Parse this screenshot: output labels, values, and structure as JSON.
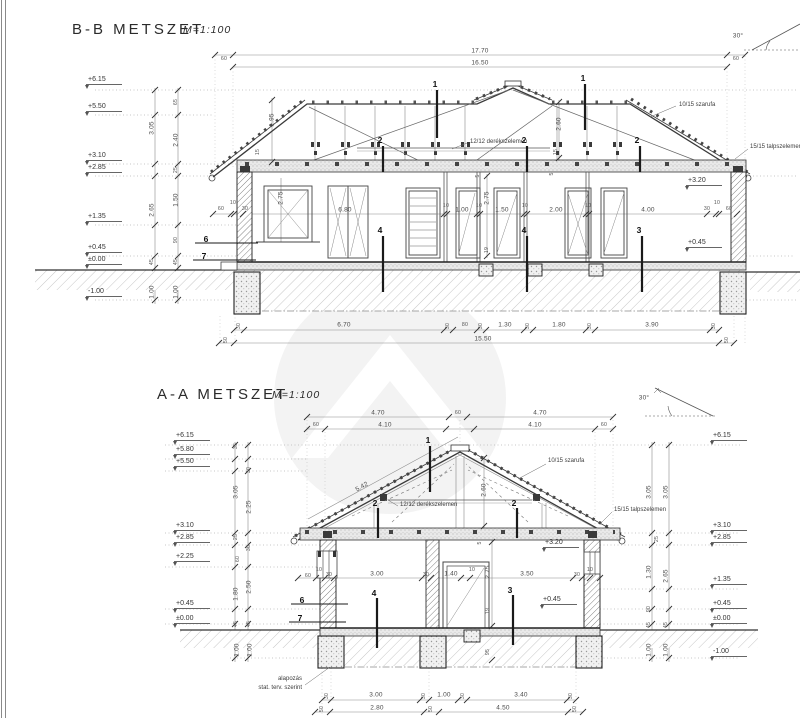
{
  "page": {
    "title_bb": "B-B METSZET",
    "scale_bb": "M=1:100",
    "title_aa": "A-A METSZET",
    "scale_aa": "M=1:100"
  },
  "bb": {
    "dims": [
      {
        "t": "17.70",
        "x": 480,
        "y": 51
      },
      {
        "t": "16.50",
        "x": 480,
        "y": 63
      },
      {
        "t": "60",
        "x": 224,
        "y": 59,
        "s": 1
      },
      {
        "t": "60",
        "x": 736,
        "y": 59,
        "s": 1
      },
      {
        "t": "30°",
        "x": 738,
        "y": 36
      },
      {
        "t": "3.05",
        "x": 152,
        "y": 128,
        "r": 1
      },
      {
        "t": "65",
        "x": 176,
        "y": 102,
        "r": 1,
        "s": 1
      },
      {
        "t": "2.40",
        "x": 176,
        "y": 140,
        "r": 1
      },
      {
        "t": "25",
        "x": 176,
        "y": 170,
        "r": 1,
        "s": 1
      },
      {
        "t": "2.65",
        "x": 152,
        "y": 210,
        "r": 1
      },
      {
        "t": "1.50",
        "x": 176,
        "y": 200,
        "r": 1
      },
      {
        "t": "90",
        "x": 176,
        "y": 240,
        "r": 1,
        "s": 1
      },
      {
        "t": "45",
        "x": 152,
        "y": 262,
        "r": 1,
        "s": 1
      },
      {
        "t": "45",
        "x": 176,
        "y": 262,
        "r": 1,
        "s": 1
      },
      {
        "t": "1.00",
        "x": 152,
        "y": 292,
        "r": 1
      },
      {
        "t": "1.00",
        "x": 176,
        "y": 292,
        "r": 1
      },
      {
        "t": "1.95",
        "x": 272,
        "y": 120,
        "r": 1
      },
      {
        "t": "15",
        "x": 258,
        "y": 152,
        "r": 1,
        "s": 1
      },
      {
        "t": "60",
        "x": 221,
        "y": 209,
        "s": 1
      },
      {
        "t": "10",
        "x": 233,
        "y": 203,
        "s": 1
      },
      {
        "t": "30",
        "x": 245,
        "y": 209,
        "s": 1
      },
      {
        "t": "6.80",
        "x": 345,
        "y": 210
      },
      {
        "t": "10",
        "x": 446,
        "y": 206,
        "s": 1
      },
      {
        "t": "1.00",
        "x": 462,
        "y": 210
      },
      {
        "t": "10",
        "x": 479,
        "y": 206,
        "s": 1
      },
      {
        "t": "1.50",
        "x": 502,
        "y": 210
      },
      {
        "t": "10",
        "x": 525,
        "y": 206,
        "s": 1
      },
      {
        "t": "2.00",
        "x": 556,
        "y": 210
      },
      {
        "t": "10",
        "x": 588,
        "y": 206,
        "s": 1
      },
      {
        "t": "4.00",
        "x": 648,
        "y": 210
      },
      {
        "t": "30",
        "x": 707,
        "y": 209,
        "s": 1
      },
      {
        "t": "10",
        "x": 717,
        "y": 203,
        "s": 1
      },
      {
        "t": "60",
        "x": 729,
        "y": 209,
        "s": 1
      },
      {
        "t": "5",
        "x": 478,
        "y": 176,
        "r": 1,
        "s": 1
      },
      {
        "t": "2.75",
        "x": 487,
        "y": 198,
        "r": 1
      },
      {
        "t": "19",
        "x": 487,
        "y": 250,
        "r": 1,
        "s": 1
      },
      {
        "t": "2.75",
        "x": 281,
        "y": 198,
        "r": 1
      },
      {
        "t": "2.60",
        "x": 559,
        "y": 124,
        "r": 1
      },
      {
        "t": "15",
        "x": 556,
        "y": 152,
        "r": 1,
        "s": 1
      },
      {
        "t": "5",
        "x": 552,
        "y": 174,
        "r": 1,
        "s": 1
      },
      {
        "t": "30",
        "x": 239,
        "y": 326,
        "r": 1,
        "s": 1
      },
      {
        "t": "6.70",
        "x": 344,
        "y": 325
      },
      {
        "t": "30",
        "x": 448,
        "y": 326,
        "r": 1,
        "s": 1
      },
      {
        "t": "80",
        "x": 465,
        "y": 325,
        "s": 1
      },
      {
        "t": "30",
        "x": 481,
        "y": 326,
        "r": 1,
        "s": 1
      },
      {
        "t": "1.30",
        "x": 505,
        "y": 325
      },
      {
        "t": "30",
        "x": 528,
        "y": 326,
        "r": 1,
        "s": 1
      },
      {
        "t": "1.80",
        "x": 559,
        "y": 325
      },
      {
        "t": "30",
        "x": 590,
        "y": 326,
        "r": 1,
        "s": 1
      },
      {
        "t": "3.90",
        "x": 652,
        "y": 325
      },
      {
        "t": "30",
        "x": 714,
        "y": 326,
        "r": 1,
        "s": 1
      },
      {
        "t": "50",
        "x": 226,
        "y": 340,
        "r": 1,
        "s": 1
      },
      {
        "t": "15.50",
        "x": 483,
        "y": 339
      },
      {
        "t": "50",
        "x": 727,
        "y": 340,
        "r": 1,
        "s": 1
      }
    ],
    "elevs": [
      {
        "t": "+6.15",
        "x": 86,
        "y": 76
      },
      {
        "t": "+5.50",
        "x": 86,
        "y": 103
      },
      {
        "t": "+3.10",
        "x": 86,
        "y": 152
      },
      {
        "t": "+2.85",
        "x": 86,
        "y": 164
      },
      {
        "t": "+1.35",
        "x": 86,
        "y": 213
      },
      {
        "t": "+0.45",
        "x": 86,
        "y": 244
      },
      {
        "t": "±0.00",
        "x": 86,
        "y": 256
      },
      {
        "t": "-1.00",
        "x": 86,
        "y": 288
      },
      {
        "t": "+3.20",
        "x": 686,
        "y": 177
      },
      {
        "t": "+0.45",
        "x": 686,
        "y": 239
      }
    ],
    "labels": [
      {
        "t": "1",
        "x": 435,
        "y": 84
      },
      {
        "t": "1",
        "x": 583,
        "y": 78
      },
      {
        "t": "2",
        "x": 380,
        "y": 140
      },
      {
        "t": "2",
        "x": 524,
        "y": 140
      },
      {
        "t": "2",
        "x": 637,
        "y": 140
      },
      {
        "t": "4",
        "x": 380,
        "y": 230
      },
      {
        "t": "4",
        "x": 524,
        "y": 230
      },
      {
        "t": "3",
        "x": 639,
        "y": 230
      },
      {
        "t": "6",
        "x": 206,
        "y": 239
      },
      {
        "t": "7",
        "x": 204,
        "y": 256
      }
    ],
    "notes": [
      {
        "t": "10/15 szarufa",
        "x": 679,
        "y": 105
      },
      {
        "t": "12/12 derékszelemen",
        "x": 470,
        "y": 142
      },
      {
        "t": "15/15 talpszelemen",
        "x": 750,
        "y": 147
      }
    ]
  },
  "aa": {
    "dims": [
      {
        "t": "4.70",
        "x": 378,
        "y": 413
      },
      {
        "t": "60",
        "x": 458,
        "y": 413,
        "s": 1
      },
      {
        "t": "4.70",
        "x": 540,
        "y": 413
      },
      {
        "t": "60",
        "x": 316,
        "y": 425,
        "s": 1
      },
      {
        "t": "4.10",
        "x": 385,
        "y": 425
      },
      {
        "t": "4.10",
        "x": 535,
        "y": 425
      },
      {
        "t": "60",
        "x": 604,
        "y": 425,
        "s": 1
      },
      {
        "t": "30°",
        "x": 644,
        "y": 398
      },
      {
        "t": "35",
        "x": 236,
        "y": 446,
        "r": 1,
        "s": 1
      },
      {
        "t": "30",
        "x": 249,
        "y": 470,
        "r": 1,
        "s": 1
      },
      {
        "t": "3.05",
        "x": 236,
        "y": 492,
        "r": 1
      },
      {
        "t": "2.25",
        "x": 249,
        "y": 507,
        "r": 1
      },
      {
        "t": "25",
        "x": 236,
        "y": 537,
        "r": 1,
        "s": 1
      },
      {
        "t": "30",
        "x": 249,
        "y": 548,
        "r": 1,
        "s": 1
      },
      {
        "t": "60",
        "x": 238,
        "y": 559,
        "r": 1,
        "s": 1
      },
      {
        "t": "2.50",
        "x": 249,
        "y": 587,
        "r": 1
      },
      {
        "t": "1.80",
        "x": 236,
        "y": 594,
        "r": 1
      },
      {
        "t": "45",
        "x": 236,
        "y": 624,
        "r": 1,
        "s": 1
      },
      {
        "t": "45",
        "x": 249,
        "y": 624,
        "r": 1,
        "s": 1
      },
      {
        "t": "1.00",
        "x": 237,
        "y": 650,
        "r": 1
      },
      {
        "t": "1.00",
        "x": 250,
        "y": 650,
        "r": 1
      },
      {
        "t": "3.05",
        "x": 649,
        "y": 492,
        "r": 1
      },
      {
        "t": "3.05",
        "x": 666,
        "y": 492,
        "r": 1
      },
      {
        "t": "25",
        "x": 657,
        "y": 539,
        "r": 1,
        "s": 1
      },
      {
        "t": "1.30",
        "x": 649,
        "y": 572,
        "r": 1
      },
      {
        "t": "2.65",
        "x": 666,
        "y": 576,
        "r": 1
      },
      {
        "t": "90",
        "x": 649,
        "y": 609,
        "r": 1,
        "s": 1
      },
      {
        "t": "45",
        "x": 649,
        "y": 625,
        "r": 1,
        "s": 1
      },
      {
        "t": "45",
        "x": 666,
        "y": 625,
        "r": 1,
        "s": 1
      },
      {
        "t": "1.00",
        "x": 649,
        "y": 650,
        "r": 1
      },
      {
        "t": "1.00",
        "x": 666,
        "y": 650,
        "r": 1
      },
      {
        "t": "5.42",
        "x": 362,
        "y": 487,
        "a": -29
      },
      {
        "t": "2.60",
        "x": 484,
        "y": 490,
        "r": 1
      },
      {
        "t": "60",
        "x": 308,
        "y": 576,
        "s": 1
      },
      {
        "t": "10",
        "x": 319,
        "y": 570,
        "s": 1
      },
      {
        "t": "30",
        "x": 329,
        "y": 575,
        "s": 1
      },
      {
        "t": "3.00",
        "x": 377,
        "y": 574
      },
      {
        "t": "30",
        "x": 426,
        "y": 575,
        "s": 1
      },
      {
        "t": "1.40",
        "x": 451,
        "y": 574
      },
      {
        "t": "10",
        "x": 472,
        "y": 570,
        "s": 1
      },
      {
        "t": "3.50",
        "x": 527,
        "y": 574
      },
      {
        "t": "30",
        "x": 577,
        "y": 575,
        "s": 1
      },
      {
        "t": "10",
        "x": 590,
        "y": 570,
        "s": 1
      },
      {
        "t": "5",
        "x": 480,
        "y": 543,
        "r": 1,
        "s": 1
      },
      {
        "t": "2.75",
        "x": 488,
        "y": 572,
        "r": 1
      },
      {
        "t": "19",
        "x": 488,
        "y": 611,
        "r": 1,
        "s": 1
      },
      {
        "t": "95",
        "x": 488,
        "y": 652,
        "r": 1,
        "s": 1
      },
      {
        "t": "30",
        "x": 327,
        "y": 696,
        "r": 1,
        "s": 1
      },
      {
        "t": "3.00",
        "x": 376,
        "y": 695
      },
      {
        "t": "30",
        "x": 424,
        "y": 696,
        "r": 1,
        "s": 1
      },
      {
        "t": "1.00",
        "x": 444,
        "y": 695
      },
      {
        "t": "30",
        "x": 463,
        "y": 696,
        "r": 1,
        "s": 1
      },
      {
        "t": "3.40",
        "x": 521,
        "y": 695
      },
      {
        "t": "30",
        "x": 571,
        "y": 696,
        "r": 1,
        "s": 1
      },
      {
        "t": "50",
        "x": 322,
        "y": 709,
        "r": 1,
        "s": 1
      },
      {
        "t": "2.80",
        "x": 377,
        "y": 708
      },
      {
        "t": "50",
        "x": 431,
        "y": 709,
        "r": 1,
        "s": 1
      },
      {
        "t": "4.50",
        "x": 503,
        "y": 708
      },
      {
        "t": "50",
        "x": 575,
        "y": 709,
        "r": 1,
        "s": 1
      }
    ],
    "elevs": [
      {
        "t": "+6.15",
        "x": 174,
        "y": 432
      },
      {
        "t": "+5.80",
        "x": 174,
        "y": 446
      },
      {
        "t": "+5.50",
        "x": 174,
        "y": 458
      },
      {
        "t": "+3.10",
        "x": 174,
        "y": 522
      },
      {
        "t": "+2.85",
        "x": 174,
        "y": 534
      },
      {
        "t": "+2.25",
        "x": 174,
        "y": 553
      },
      {
        "t": "+0.45",
        "x": 174,
        "y": 600
      },
      {
        "t": "±0.00",
        "x": 174,
        "y": 615
      },
      {
        "t": "+6.15",
        "x": 711,
        "y": 432
      },
      {
        "t": "+3.10",
        "x": 711,
        "y": 522
      },
      {
        "t": "+2.85",
        "x": 711,
        "y": 534
      },
      {
        "t": "+1.35",
        "x": 711,
        "y": 576
      },
      {
        "t": "+0.45",
        "x": 711,
        "y": 600
      },
      {
        "t": "±0.00",
        "x": 711,
        "y": 615
      },
      {
        "t": "-1.00",
        "x": 711,
        "y": 648
      },
      {
        "t": "+3.20",
        "x": 543,
        "y": 539
      },
      {
        "t": "+0.45",
        "x": 541,
        "y": 596
      }
    ],
    "labels": [
      {
        "t": "1",
        "x": 428,
        "y": 440
      },
      {
        "t": "2",
        "x": 375,
        "y": 503
      },
      {
        "t": "2",
        "x": 514,
        "y": 503
      },
      {
        "t": "4",
        "x": 374,
        "y": 593
      },
      {
        "t": "3",
        "x": 510,
        "y": 590
      },
      {
        "t": "6",
        "x": 302,
        "y": 600
      },
      {
        "t": "7",
        "x": 300,
        "y": 618
      }
    ],
    "notes": [
      {
        "t": "10/15 szarufa",
        "x": 548,
        "y": 461
      },
      {
        "t": "12/12 derékszelemen",
        "x": 400,
        "y": 505
      },
      {
        "t": "15/15 talpszelemen",
        "x": 614,
        "y": 510
      },
      {
        "t": "alapozás",
        "x": 302,
        "y": 679,
        "ra": 1
      },
      {
        "t": "stat. terv. szerint",
        "x": 302,
        "y": 688,
        "ra": 1
      }
    ]
  }
}
